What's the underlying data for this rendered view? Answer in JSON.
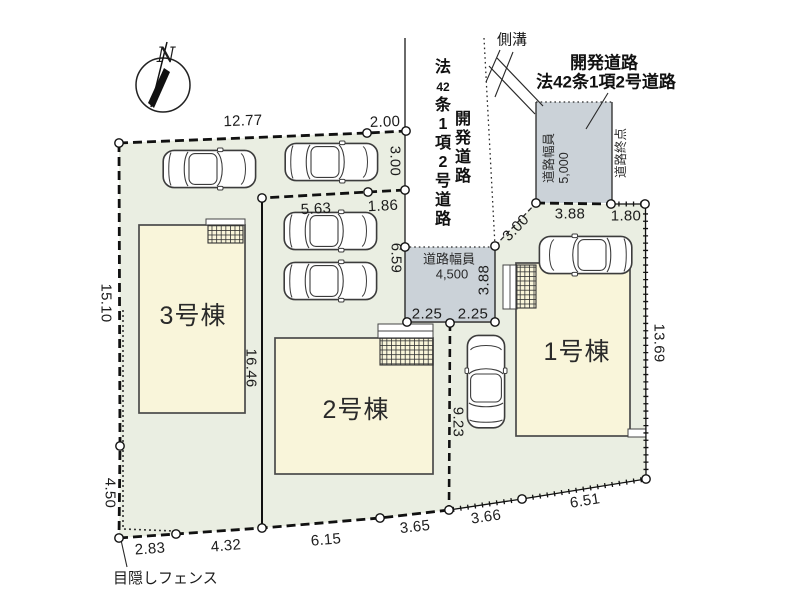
{
  "plan": {
    "compass": {
      "north_label": "N"
    },
    "buildings": {
      "b1": {
        "label": "1号棟"
      },
      "b2": {
        "label": "2号棟"
      },
      "b3": {
        "label": "3号棟"
      }
    },
    "roads": {
      "side_ditch": "側溝",
      "heading_line1": "開発道路",
      "heading_line2": "法42条1項2号道路",
      "vertical_name_main": "法42条1項2号道路",
      "vertical_name_sub": "開発道路",
      "north_width_label": "道路幅員",
      "north_width_value": "5,000",
      "road_end_label": "道路終点",
      "west_width_label": "道路幅員",
      "west_width_value": "4,500"
    },
    "fence_label": "目隠しフェンス",
    "dims": {
      "top_main": "12.77",
      "top_right": "2.00",
      "right_up": "3.00",
      "lot2_top_long": "5.63",
      "lot2_top_short": "1.86",
      "corridor": "6.59",
      "left_upper": "15.10",
      "left_lower": "4.50",
      "divider_3_2": "16.46",
      "road_side": "3.88",
      "west_road_a": "2.25",
      "west_road_b": "2.25",
      "lot1_diag": "3.00",
      "lot1_top": "3.88",
      "lot1_top_right": "1.80",
      "divider_2_1": "9.23",
      "lot1_right": "13.69",
      "bottom1": "2.83",
      "bottom2": "4.32",
      "bottom3": "6.15",
      "bottom4": "3.65",
      "bottom5": "3.66",
      "bottom6": "6.51"
    },
    "colors": {
      "parcel": "#eaeee2",
      "building": "#f9f5da",
      "road": "#cbd2d8",
      "line": "#1c1c1c"
    }
  }
}
